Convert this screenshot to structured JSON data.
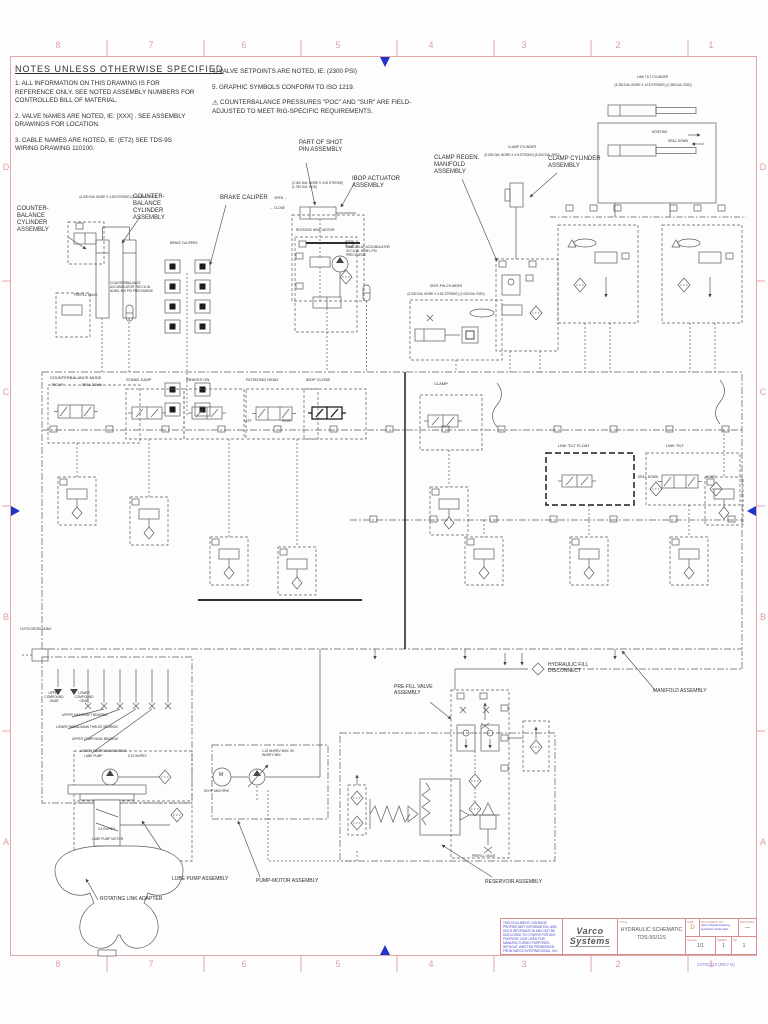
{
  "zones": {
    "columns": [
      "8",
      "7",
      "6",
      "5",
      "4",
      "3",
      "2",
      "1"
    ],
    "rows": [
      "D",
      "C",
      "B",
      "A"
    ]
  },
  "notes": {
    "title": "NOTES UNLESS OTHERWISE SPECIFIED",
    "warn_icon": "⚠",
    "items": [
      "1. ALL INFORMATION ON THIS DRAWING IS FOR REFERENCE ONLY. SEE NOTED ASSEMBLY NUMBERS FOR CONTROLLED BILL OF MATERIAL.",
      "2. VALVE NAMES ARE NOTED, IE: [XXX] . SEE ASSEMBLY DRAWINGS FOR LOCATION.",
      "3. CABLE NAMES ARE NOTED, IE: (ET2) SEE TDS-9S WIRING DRAWING 110100.",
      "4. VALVE SETPOINTS ARE NOTED, IE: (2300 PSI)",
      "5. GRAPHIC SYMBOLS CONFORM TO ISO 1219.",
      "COUNTERBALANCE PRESSURES \"POC\" AND \"SUR\" ARE FIELD-ADJUSTED TO MEET RIG-SPECIFIC REQUIREMENTS."
    ]
  },
  "callouts": {
    "counterbalance_left": "COUNTER- BALANCE CYLINDER ASSEMBLY",
    "counterbalance_right": "COUNTER- BALANCE CYLINDER ASSEMBLY",
    "counterbalance_spec": "(4.000 DIA. BORE X 4.50 STROKE) (3.500 DIA. ROD)",
    "brake_caliper": "BRAKE CALIPER",
    "brake_calipers_small": "BRAKE CALIPERS",
    "part_of_shot_pin": "PART OF SHOT PIN ASSEMBLY",
    "ibop_actuator": "IBOP ACTUATOR ASSEMBLY",
    "ibop_spec": "(2.000 DIA. BORE X 4.00 STROKE) (1.750 DIA. ROD)",
    "open_label": "OPEN →",
    "close_label": "← CLOSE",
    "rotating_head_motor": "ROTATING HEAD MOTOR",
    "counterbalance_accumulator": "COUNTERBALANCE ACCUMULATOR 750 CU.IN. NOM'L 800 PSI PRECHARGE",
    "time_delay_accumulator": "TIME-DELAY ACCUMULATOR 30 CU.IN. NOM'L PSI PRECHARGE",
    "prefill_valve_left": "PREFILL VALVE",
    "shot_pin_cylinder": "SHOT-PIN CYLINDER",
    "shot_pin_spec": "(2.000 DIA. BORE X 0.81 STROKE) (1.000 DIA. ROD)",
    "clamp_regen": "CLAMP REGEN. MANIFOLD ASSEMBLY",
    "clamp_cylinder": "CLAMP CYLINDER",
    "clamp_cylinder_spec": "(5.000 DIA. BORE X 4.0 STROKE) (4.000 DIA. ROD)",
    "clamp_cylinder_assembly": "CLAMP CYLINDER ASSEMBLY",
    "link_tilt_cylinder": "LINK TILT CYLINDER",
    "link_tilt_spec": "(3.250 DIA. BORE X 14.5 STROKE) (1.380 DIA. ROD)",
    "hoisting": "HOISTING",
    "drill_down": "DRILL DOWN",
    "hydraulic_fill": "HYDRAULIC FILL DISCONNECT",
    "manifold_assembly": "MANIFOLD ASSEMBLY",
    "prefill_assembly": "PRE-FILL VALVE ASSEMBLY",
    "prefill_valve_small": "PREFILL VALVE",
    "reservoir_assembly": "RESERVOIR ASSEMBLY",
    "lube_pump_assembly": "LUBE PUMP ASSEMBLY",
    "pump_motor_assembly": "PUMP-MOTOR ASSEMBLY",
    "rotating_link_adapter": "ROTATING LINK ADAPTER"
  },
  "manifold": {
    "sections": [
      "COUNTERBALANCE MODE",
      "STAND JUMP",
      "BRAKES ON",
      "ROTATING HEAD",
      "IBOP CLOSE",
      "CLAMP",
      "LINK TILT FLOAT",
      "LINK TILT"
    ],
    "rig_up": "RIG UP",
    "drill_down": "DRILL DOWN",
    "left": "LEFT",
    "right": "RIGHT",
    "hoist": "HOIST",
    "tilt_drill_down": "DRILL DOWN"
  },
  "lube": {
    "pressure_switch": "15 PSI DECREASING",
    "gears": [
      "UPPER COMPOUND GEAR",
      "LOWER COMPOUND GEAR"
    ],
    "bearings": [
      "UPPER MAINSHAFT BEARING",
      "LOWER RADIAL/MAIN THRUST BEARING",
      "UPPER COMPOUND BEARING",
      "LOWER COMPOUND BEARING"
    ],
    "pump_label": "LUBE PUMP",
    "pump_disp": "5.12 IN³/REV",
    "motor_disp": "3.6 IN³/REV",
    "motor_label": "LUBE PUMP MOTOR"
  },
  "pump": {
    "motor_letter": "M",
    "motor_rating": "50 HP 1800 RPM",
    "displacement": "1.15 IN³/REV MAX  .90 IN³/REV MIN"
  },
  "title_block": {
    "proprietary": "THIS DOCUMENT CONTAINS PROPRIETARY INFORMATION, AND SUCH INFORMATION MAY NOT BE DISCLOSED TO OTHERS FOR ANY PURPOSE, NOR USED FOR MANUFACTURING PURPOSES WITHOUT WRITTEN PERMISSION FROM VARCO INTERNATIONAL, INC.",
    "logo_top": "Varco",
    "logo_bottom": "Systems",
    "title_label": "TITLE",
    "title_line1": "HYDRAULIC SCHEMATIC",
    "title_line2": "TDS-9S/11S",
    "size_label": "SIZE",
    "size_value": "D",
    "doc_label": "DOCUMENT NO.",
    "doc_value": "Varco Digital Drawing Hydraulic Schematic",
    "revision_label": "REVISION",
    "revision_value": "—",
    "scale_label": "SCALE",
    "scale_value": "1/1",
    "sheet_label": "SHEET",
    "sheet_value": "1",
    "of_label": "OF",
    "of_value": "1"
  },
  "corner_note": "24750222 (REV B)"
}
